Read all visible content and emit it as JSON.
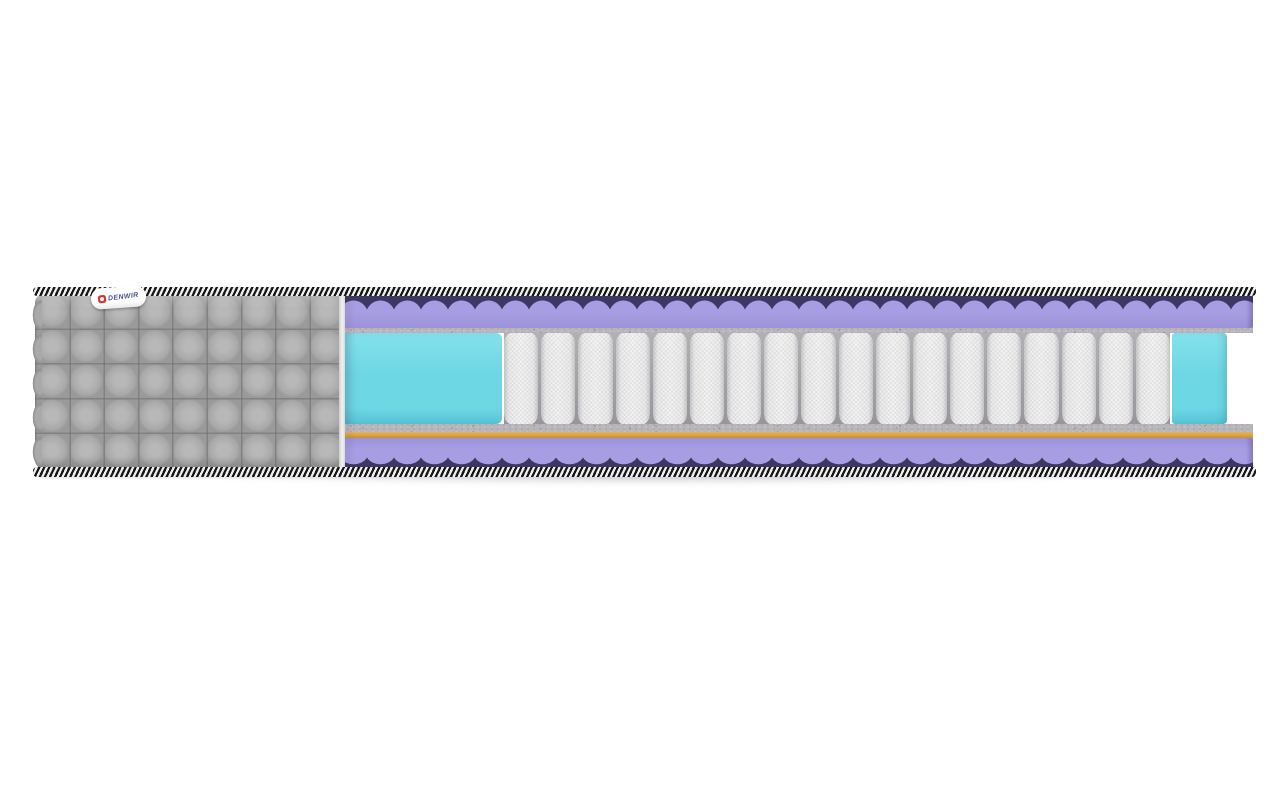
{
  "image": {
    "kind": "product-photo-render",
    "subject": "Mattress cutaway cross-section on white background",
    "background_color": "#ffffff"
  },
  "brand_tag": {
    "text": "DENWIR"
  },
  "springs": {
    "count": 18,
    "description": "independent pocket spring block"
  },
  "layers": [
    {
      "name": "striped edge tape (top)"
    },
    {
      "name": "wave-cut foam layer (top)"
    },
    {
      "name": "felt pad (top)"
    },
    {
      "name": "soft foam edge block (left)"
    },
    {
      "name": "pocket spring block"
    },
    {
      "name": "soft foam edge block (right)"
    },
    {
      "name": "felt pad (bottom)"
    },
    {
      "name": "coir layer"
    },
    {
      "name": "wave-cut foam layer (bottom)"
    },
    {
      "name": "striped edge tape (bottom)"
    },
    {
      "name": "quilted grey cover"
    }
  ],
  "colors": {
    "bg": "#ffffff",
    "cover": "#a9a9a9",
    "cover_dark": "#8f8f8f",
    "tape_dark": "#171717",
    "tape_light": "#f0f0f0",
    "purple": "#a69de2",
    "purple_deep": "#9c92d8",
    "navy": "#3d3862",
    "felt": "#b9b6ba",
    "felt_dark": "#908c90",
    "felt_light": "#dcd8dc",
    "fleck_red": "#cf4a3e",
    "fleck_blue": "#5a6aa8",
    "cyan": "#6ed7e4",
    "cyan_light": "#85e2ec",
    "cyan_dark": "#57c5d6",
    "coil": "#f4f4f5",
    "coil_edge": "#c9c9cb",
    "coir": "#d8a24a",
    "coir_light": "#e4b35c",
    "coir_dark": "#c18f3c",
    "logo_red": "#d8352b",
    "logo_text": "#44508e",
    "shadow": "rgba(110,110,125,0.30)"
  }
}
